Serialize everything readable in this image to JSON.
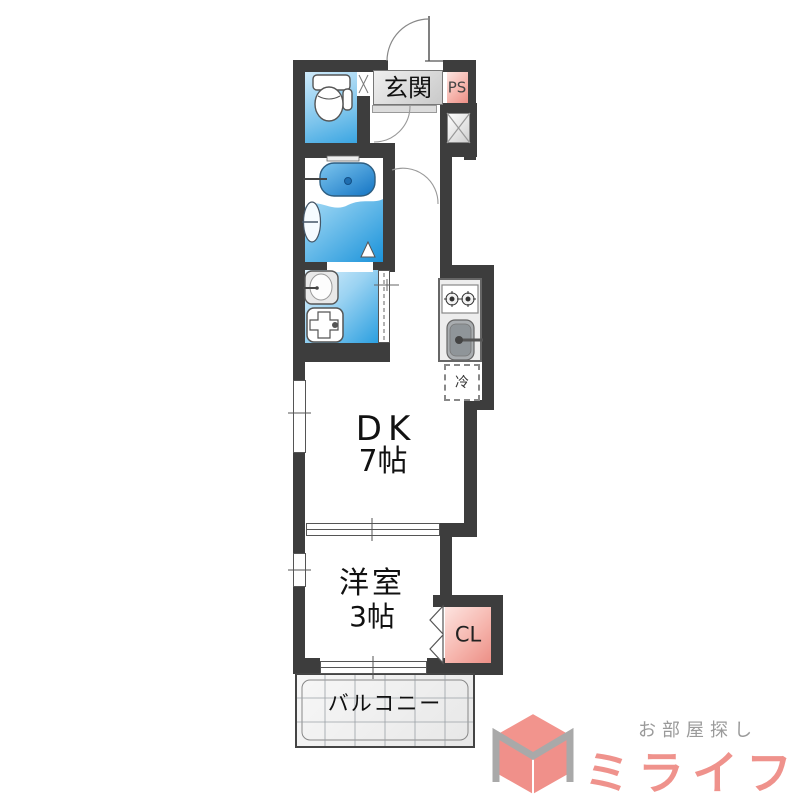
{
  "floorplan": {
    "rooms": {
      "entrance_label": "玄関",
      "ps_label": "PS",
      "dk_label": "DK",
      "dk_size": "7帖",
      "western_room_label": "洋室",
      "western_room_size": "3帖",
      "closet_label": "CL",
      "balcony_label": "バルコニー",
      "fridge_label": "冷"
    },
    "colors": {
      "wall": "#3d3d3d",
      "water_light": "#dff2fd",
      "water_deep": "#2b9fe0",
      "pink_light": "#fde4e0",
      "pink_deep": "#ec8f86",
      "entrance_gray": "#d9d9d9",
      "balcony_gray": "#efefef"
    }
  },
  "logo": {
    "tagline": "お部屋探し",
    "brand": "ミライフ",
    "brand_color": "#ef928c",
    "tagline_color": "#9a9a9a"
  }
}
